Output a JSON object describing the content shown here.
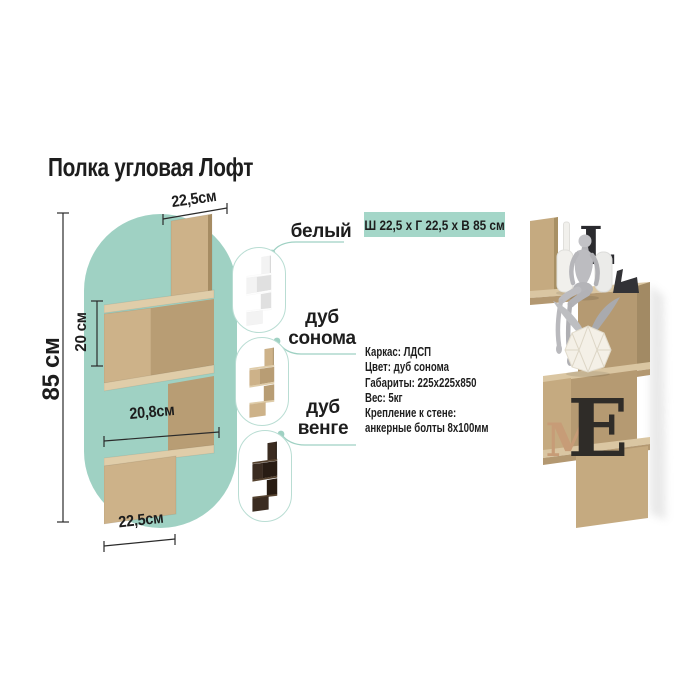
{
  "title": "Полка угловая Лофт",
  "colors": {
    "accent_teal": "#9fd1c3",
    "badge_teal": "#a4d6c8",
    "oak_front": "#cdb289",
    "oak_top": "#e0cda9",
    "oak_inner": "#b89d74",
    "wenge_dark": "#3b2c21",
    "white_shelf": "#f3f3f3",
    "text": "#1d1d1d"
  },
  "diagram": {
    "dim_top_width": "22,5см",
    "dim_height": "85 см",
    "dim_section_height": "20 см",
    "dim_inner_width": "20,8см",
    "dim_bottom_width": "22,5см"
  },
  "swatches": [
    {
      "label": "белый",
      "color": "#f3f3f3"
    },
    {
      "label": "дуб сонома",
      "color": "#cdb289"
    },
    {
      "label": "дуб венге",
      "color": "#3b2c21"
    }
  ],
  "size_badge": "Ш 22,5 х Г 22,5 х В 85 см",
  "specs": {
    "lines": [
      "Каркас: ЛДСП",
      "Цвет: дуб сонома",
      "Габариты: 225х225х850",
      "Вес: 5кг",
      "Крепление к стене:",
      "анкерные болты 8х100мм"
    ]
  },
  "photo": {
    "letters": {
      "top": "L",
      "shelf_e": "E",
      "shelf_m": "M"
    }
  }
}
